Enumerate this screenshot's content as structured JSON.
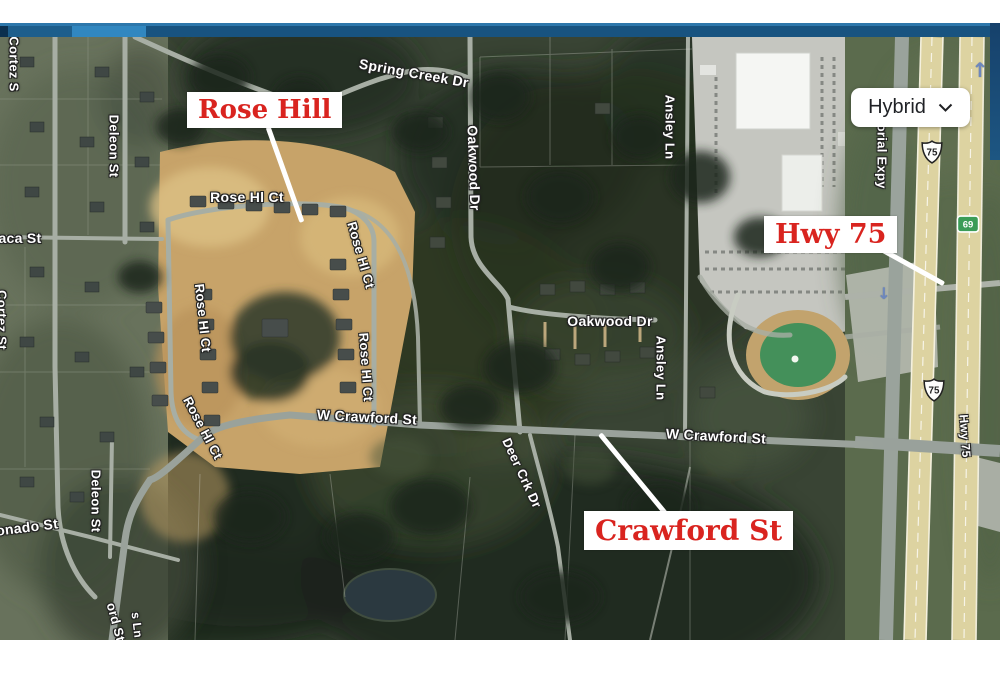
{
  "window": {
    "theme": {
      "title_bar_blue": "#185380",
      "title_bar_highlight": "#3187c0",
      "edge_strip_blue": "#1c4e79"
    }
  },
  "map": {
    "type_control": {
      "label": "Hybrid"
    },
    "annotation_style": {
      "text_color": "#d9241f",
      "box_bg": "#ffffff",
      "pointer_color": "#ffffff"
    },
    "annotations": [
      {
        "text": "Rose Hill",
        "box": {
          "x": 187,
          "y": 92
        },
        "pointer": {
          "x1": 268,
          "y1": 127,
          "x2": 302,
          "y2": 222
        },
        "font_px": 26
      },
      {
        "text": "Hwy 75",
        "box": {
          "x": 764,
          "y": 216
        },
        "pointer": {
          "x1": 866,
          "y1": 241,
          "x2": 944,
          "y2": 284
        },
        "font_px": 27
      },
      {
        "text": "Crawford St",
        "box": {
          "x": 584,
          "y": 511
        },
        "pointer": {
          "x1": 600,
          "y1": 434,
          "x2": 666,
          "y2": 514
        },
        "font_px": 28
      }
    ],
    "street_labels": [
      {
        "text": "Cortez S",
        "x": 14,
        "y": 64,
        "rot": 90,
        "size": 13
      },
      {
        "text": "Deleon St",
        "x": 114,
        "y": 146,
        "rot": 90,
        "size": 13
      },
      {
        "text": "aca St",
        "x": 20,
        "y": 238,
        "rot": 0,
        "size": 14
      },
      {
        "text": "Cortez St",
        "x": 2,
        "y": 320,
        "rot": 90,
        "size": 13
      },
      {
        "text": "onado St",
        "x": 27,
        "y": 527,
        "rot": -7,
        "size": 14
      },
      {
        "text": "Deleon St",
        "x": 96,
        "y": 501,
        "rot": 90,
        "size": 13
      },
      {
        "text": "Spring Creek Dr",
        "x": 414,
        "y": 73,
        "rot": 10,
        "size": 14
      },
      {
        "text": "Rose Hl Ct",
        "x": 247,
        "y": 197,
        "rot": 0,
        "size": 14
      },
      {
        "text": "Rose Hl Ct",
        "x": 361,
        "y": 255,
        "rot": 74,
        "size": 13
      },
      {
        "text": "Rose Hl Ct",
        "x": 203,
        "y": 318,
        "rot": 84,
        "size": 13
      },
      {
        "text": "Rose Hl Ct",
        "x": 366,
        "y": 367,
        "rot": 86,
        "size": 13
      },
      {
        "text": "Rose Hl Ct",
        "x": 203,
        "y": 428,
        "rot": 62,
        "size": 13
      },
      {
        "text": "Oakwood Dr",
        "x": 474,
        "y": 168,
        "rot": 88,
        "size": 14
      },
      {
        "text": "Ansley Ln",
        "x": 670,
        "y": 127,
        "rot": 90,
        "size": 13
      },
      {
        "text": "Oakwood Dr",
        "x": 610,
        "y": 321,
        "rot": 0,
        "size": 14
      },
      {
        "text": "Ansley Ln",
        "x": 661,
        "y": 368,
        "rot": 90,
        "size": 13
      },
      {
        "text": "W Crawford St",
        "x": 367,
        "y": 417,
        "rot": 3,
        "size": 14
      },
      {
        "text": "W Crawford St",
        "x": 716,
        "y": 436,
        "rot": 3,
        "size": 14
      },
      {
        "text": "Deer Crk Dr",
        "x": 522,
        "y": 473,
        "rot": 65,
        "size": 13
      },
      {
        "text": "Memorial Expy",
        "x": 882,
        "y": 141,
        "rot": 90,
        "size": 13
      },
      {
        "text": "Hwy 75",
        "x": 965,
        "y": 436,
        "rot": 86,
        "size": 12
      },
      {
        "text": "ord St",
        "x": 116,
        "y": 622,
        "rot": 75,
        "size": 13
      },
      {
        "text": "s Ln",
        "x": 137,
        "y": 625,
        "rot": 83,
        "size": 12
      }
    ],
    "route_shields": [
      {
        "style": "us-route",
        "number": "75",
        "x": 932,
        "y": 152
      },
      {
        "style": "state-green",
        "number": "69",
        "x": 968,
        "y": 224
      },
      {
        "style": "us-route",
        "number": "75",
        "x": 934,
        "y": 390
      }
    ],
    "direction_arrows": [
      {
        "glyph": "↑",
        "x": 980,
        "y": 70,
        "size": 20
      },
      {
        "glyph": "↓",
        "x": 884,
        "y": 294,
        "size": 16
      }
    ]
  }
}
